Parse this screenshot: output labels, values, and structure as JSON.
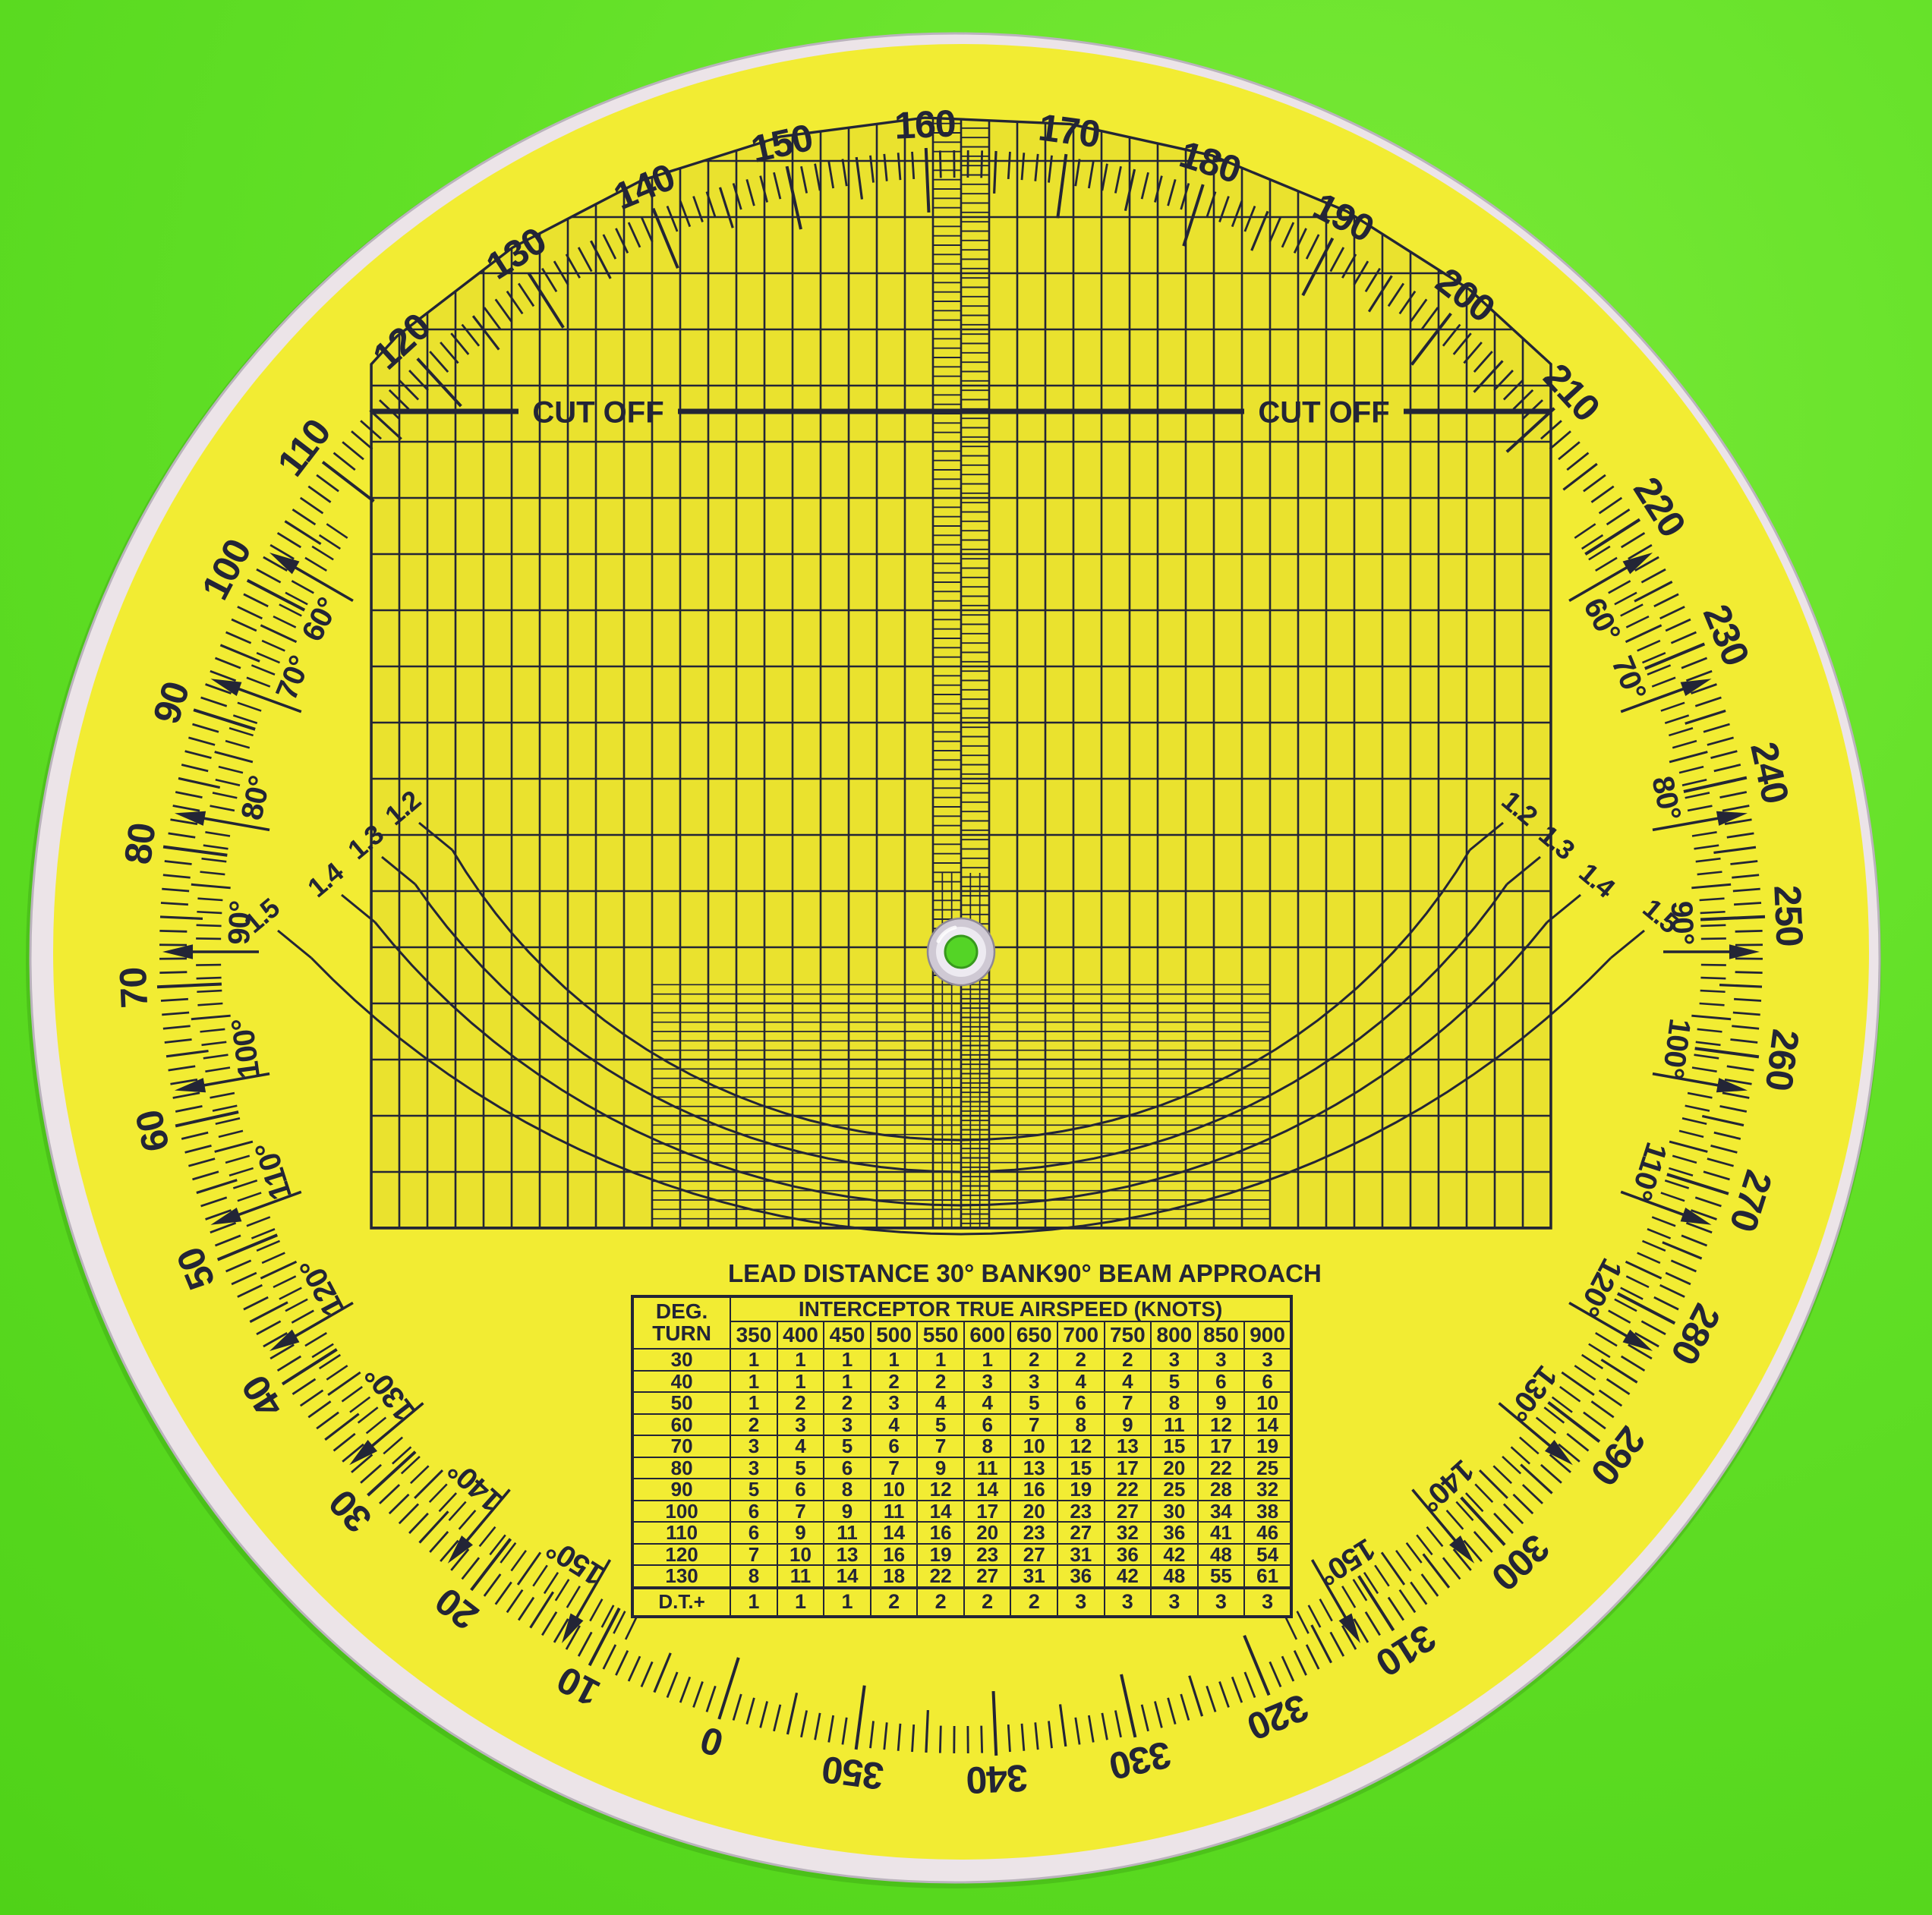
{
  "colors": {
    "background_green": "#5fdf27",
    "disc_yellow": "#f2ec33",
    "rim_white": "#ece4e8",
    "ink_navy": "#232536",
    "grommet_silver": "#cfc9d4",
    "hole_green": "#54d426"
  },
  "dial": {
    "top_value": 162.5,
    "outer_labels": [
      "0",
      "10",
      "20",
      "30",
      "40",
      "50",
      "60",
      "70",
      "80",
      "90",
      "100",
      "110",
      "120",
      "130",
      "140",
      "150",
      "160",
      "170",
      "180",
      "190",
      "200",
      "210",
      "220",
      "230",
      "240",
      "250",
      "260",
      "270",
      "280",
      "290",
      "300",
      "310",
      "320",
      "330",
      "340",
      "350"
    ],
    "inner_labels": [
      "60°",
      "70°",
      "80°",
      "90°",
      "100°",
      "110°",
      "120°",
      "130°",
      "140°",
      "150°"
    ],
    "cutoff_label": "CUT OFF"
  },
  "curves": {
    "labels": [
      "1.2",
      "1.3",
      "1.4",
      "1.5"
    ]
  },
  "table": {
    "title_left": "LEAD DISTANCE 30° BANK",
    "title_right": "90° BEAM APPROACH",
    "corner_line1": "DEG.",
    "corner_line2": "TURN",
    "span_header": "INTERCEPTOR TRUE AIRSPEED (KNOTS)",
    "speeds": [
      "350",
      "400",
      "450",
      "500",
      "550",
      "600",
      "650",
      "700",
      "750",
      "800",
      "850",
      "900"
    ],
    "rows": [
      [
        "30",
        1,
        1,
        1,
        1,
        1,
        1,
        2,
        2,
        2,
        3,
        3,
        3
      ],
      [
        "40",
        1,
        1,
        1,
        2,
        2,
        3,
        3,
        4,
        4,
        5,
        6,
        6
      ],
      [
        "50",
        1,
        2,
        2,
        3,
        4,
        4,
        5,
        6,
        7,
        8,
        9,
        10
      ],
      [
        "60",
        2,
        3,
        3,
        4,
        5,
        6,
        7,
        8,
        9,
        11,
        12,
        14
      ],
      [
        "70",
        3,
        4,
        5,
        6,
        7,
        8,
        10,
        12,
        13,
        15,
        17,
        19
      ],
      [
        "80",
        3,
        5,
        6,
        7,
        9,
        11,
        13,
        15,
        17,
        20,
        22,
        25
      ],
      [
        "90",
        5,
        6,
        8,
        10,
        12,
        14,
        16,
        19,
        22,
        25,
        28,
        32
      ],
      [
        "100",
        6,
        7,
        9,
        11,
        14,
        17,
        20,
        23,
        27,
        30,
        34,
        38
      ],
      [
        "110",
        6,
        9,
        11,
        14,
        16,
        20,
        23,
        27,
        32,
        36,
        41,
        46
      ],
      [
        "120",
        7,
        10,
        13,
        16,
        19,
        23,
        27,
        31,
        36,
        42,
        48,
        54
      ],
      [
        "130",
        8,
        11,
        14,
        18,
        22,
        27,
        31,
        36,
        42,
        48,
        55,
        61
      ]
    ],
    "dt_label": "D.T.+",
    "dt_values": [
      1,
      1,
      1,
      2,
      2,
      2,
      2,
      3,
      3,
      3,
      3,
      3
    ]
  }
}
